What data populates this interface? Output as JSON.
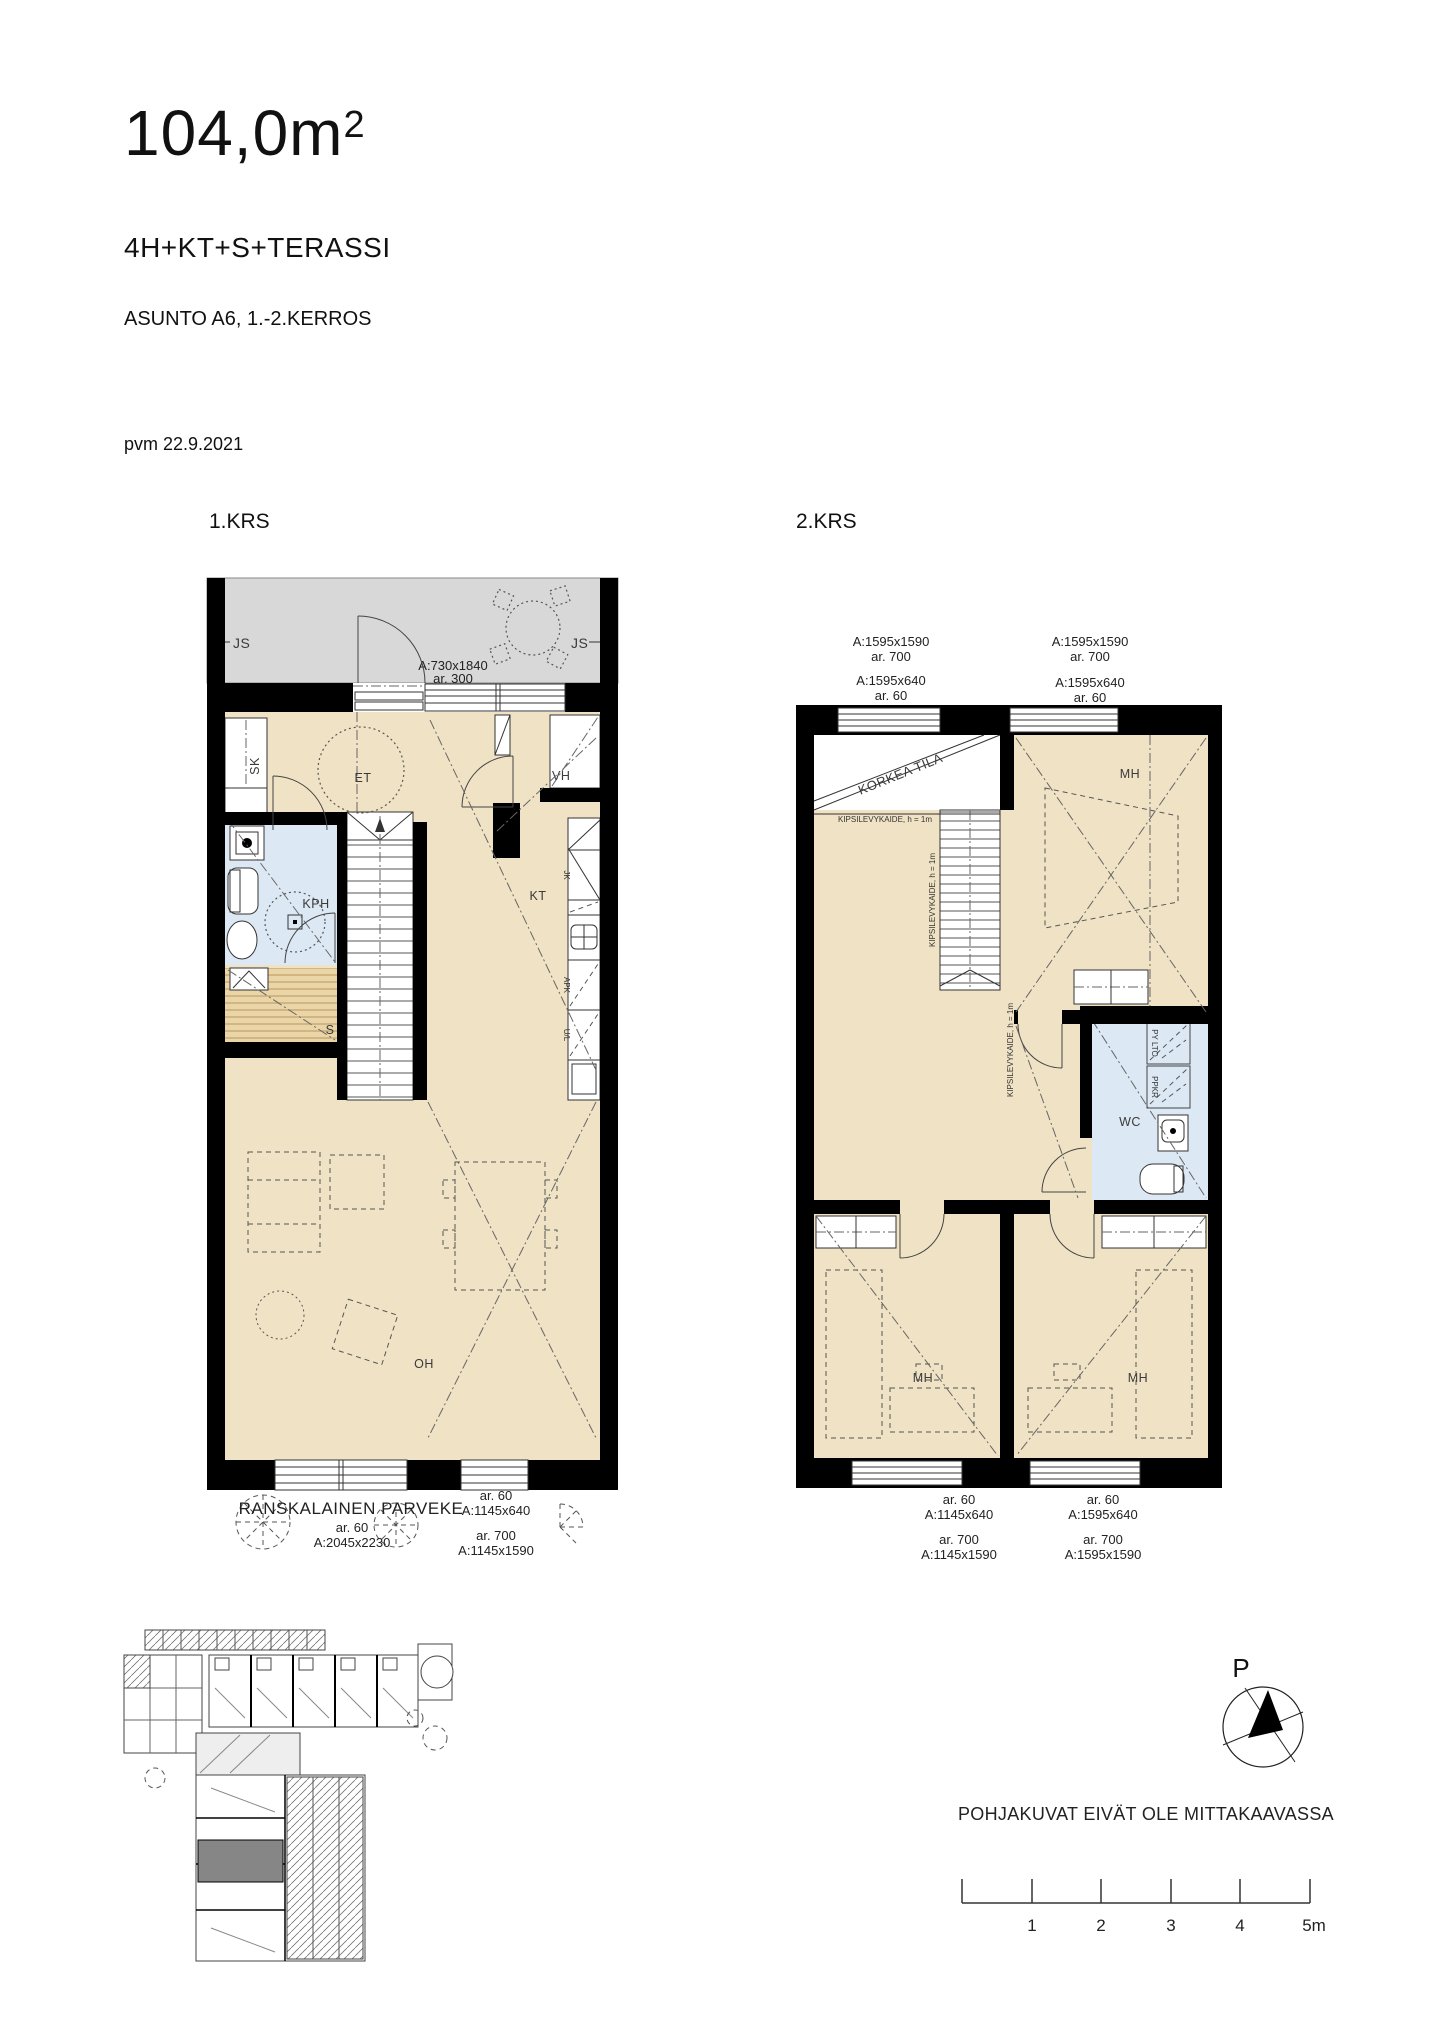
{
  "header": {
    "area_value": "104,0m",
    "area_sup": "2",
    "apartment_type": "4H+KT+S+TERASSI",
    "apartment_info": "ASUNTO A6, 1.-2.KERROS",
    "date": "pvm 22.9.2021"
  },
  "colors": {
    "floor": "#F0E3C5",
    "wet_room": "#DCE8F4",
    "terrace": "#D8D8D8",
    "sauna": "#E9D5A8",
    "wall": "#000000",
    "site_highlight": "#868686"
  },
  "floor1": {
    "label": "1.KRS",
    "terrace": {
      "js_left": "JS",
      "js_right": "JS",
      "door_dim": "A:730x1840",
      "door_area": "ar. 300"
    },
    "rooms": {
      "sk": "SK",
      "et": "ET",
      "vh": "VH",
      "kph": "KPH",
      "kt": "KT",
      "s": "S",
      "oh": "OH"
    },
    "kitchen": {
      "jk": "JK",
      "apk": "APK",
      "ul": "U/L"
    },
    "bottom": {
      "balcony": "RANSKALAINEN PARVEKE",
      "balcony_area": "ar. 60",
      "balcony_dim": "A:2045x2230",
      "win_area": "ar. 60",
      "win_dim": "A:1145x640",
      "door_area": "ar. 700",
      "door_dim": "A:1145x1590"
    }
  },
  "floor2": {
    "label": "2.KRS",
    "top_left": {
      "dim1": "A:1595x1590",
      "area1": "ar. 700",
      "dim2": "A:1595x640",
      "area2": "ar. 60"
    },
    "top_right": {
      "dim1": "A:1595x1590",
      "area1": "ar. 700",
      "dim2": "A:1595x640",
      "area2": "ar. 60"
    },
    "korkea_tila": "KORKEA TILA",
    "railing1": "KIPSILEVYKAIDE, h = 1m",
    "railing2": "KIPSILEVYKAIDE, h = 1m",
    "railing3": "KIPSILEVYKAIDE, h = 1m",
    "rooms": {
      "mh_top": "MH",
      "mh_left": "MH",
      "mh_right": "MH",
      "wc": "WC"
    },
    "wc_fixtures": {
      "top": "PY LTO",
      "bottom": "PPKR"
    },
    "bottom_left": {
      "area1": "ar. 60",
      "dim1": "A:1145x640",
      "area2": "ar. 700",
      "dim2": "A:1145x1590"
    },
    "bottom_right": {
      "area1": "ar. 60",
      "dim1": "A:1595x640",
      "area2": "ar. 700",
      "dim2": "A:1595x1590"
    }
  },
  "footer": {
    "north_label": "P",
    "disclaimer": "POHJAKUVAT EIVÄT OLE MITTAKAAVASSA",
    "scale_labels": [
      "1",
      "2",
      "3",
      "4",
      "5m"
    ]
  }
}
